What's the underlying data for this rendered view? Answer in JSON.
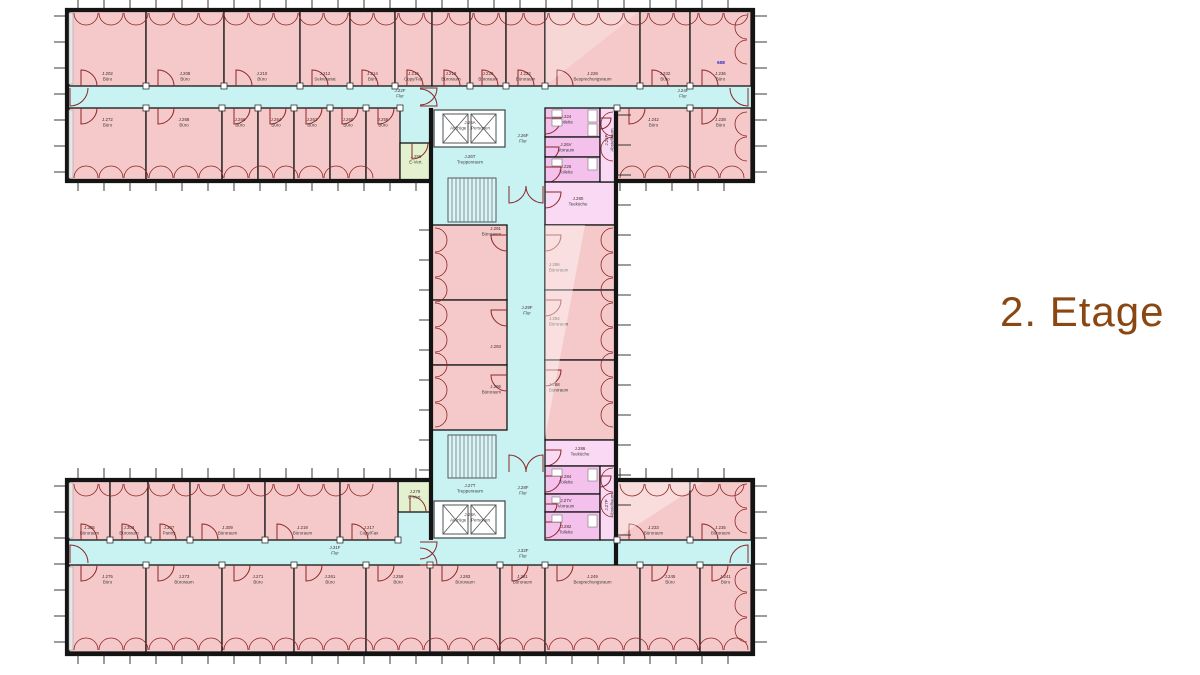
{
  "title": {
    "text": "2. Etage",
    "color": "#8a4711"
  },
  "colors": {
    "office": "#f5c9c9",
    "corridor": "#c9f3f3",
    "service": "#f4c0ec",
    "serviceLight": "#f9d9f4",
    "utility": "#e4f1cf",
    "wall": "#141414",
    "door": "#8d2525",
    "label": "#3c3c3c",
    "labelId": "#4a2b2b",
    "elevator": "#fbffff",
    "annotation": "#2323cc"
  },
  "floorplan": {
    "zones": [
      [
        69,
        86,
        682,
        22
      ],
      [
        69,
        540,
        682,
        25
      ],
      [
        507,
        108,
        38,
        457
      ],
      [
        398,
        108,
        34,
        36
      ],
      [
        398,
        512,
        34,
        28
      ],
      [
        432,
        108,
        75,
        117
      ],
      [
        432,
        430,
        75,
        110
      ]
    ],
    "rooms": [
      {
        "id": "J.202",
        "name": "Büro",
        "x": 69,
        "y": 11,
        "w": 77,
        "h": 75,
        "fill": "office",
        "door": "s"
      },
      {
        "id": "J.208",
        "name": "Büro",
        "x": 146,
        "y": 11,
        "w": 78,
        "h": 75,
        "fill": "office",
        "door": "s"
      },
      {
        "id": "J.210",
        "name": "Büro",
        "x": 224,
        "y": 11,
        "w": 76,
        "h": 75,
        "fill": "office",
        "door": "s"
      },
      {
        "id": "J.212",
        "name": "Sekretariat",
        "x": 300,
        "y": 11,
        "w": 50,
        "h": 75,
        "fill": "office",
        "door": "s"
      },
      {
        "id": "J.214",
        "name": "Büro",
        "x": 350,
        "y": 11,
        "w": 45,
        "h": 75,
        "fill": "office",
        "door": "s"
      },
      {
        "id": "J.216",
        "name": "Copy/Fax",
        "x": 395,
        "y": 11,
        "w": 37,
        "h": 75,
        "fill": "office",
        "door": "s"
      },
      {
        "id": "J.218",
        "name": "Büroraum",
        "x": 432,
        "y": 11,
        "w": 38,
        "h": 75,
        "fill": "office",
        "door": "s"
      },
      {
        "id": "J.220",
        "name": "Büroraum",
        "x": 470,
        "y": 11,
        "w": 36,
        "h": 75,
        "fill": "office",
        "door": "s"
      },
      {
        "id": "J.222",
        "name": "Büroraum",
        "x": 506,
        "y": 11,
        "w": 39,
        "h": 75,
        "fill": "office",
        "door": "s"
      },
      {
        "id": "J.228",
        "name": "Besprechungsraum",
        "x": 545,
        "y": 11,
        "w": 95,
        "h": 75,
        "fill": "office",
        "door": "s"
      },
      {
        "id": "J.232",
        "name": "Büro",
        "x": 640,
        "y": 11,
        "w": 50,
        "h": 75,
        "fill": "office",
        "door": "s"
      },
      {
        "id": "J.236",
        "name": "Büro",
        "x": 690,
        "y": 11,
        "w": 61,
        "h": 75,
        "fill": "office",
        "door": "s"
      },
      {
        "id": "J.272",
        "name": "Büro",
        "x": 69,
        "y": 108,
        "w": 77,
        "h": 72,
        "fill": "office",
        "door": "n"
      },
      {
        "id": "J.268",
        "name": "Büro",
        "x": 146,
        "y": 108,
        "w": 76,
        "h": 72,
        "fill": "office",
        "door": "n"
      },
      {
        "id": "J.266",
        "name": "Büro",
        "x": 222,
        "y": 108,
        "w": 36,
        "h": 72,
        "fill": "office",
        "door": "n"
      },
      {
        "id": "J.264",
        "name": "Büro",
        "x": 258,
        "y": 108,
        "w": 36,
        "h": 72,
        "fill": "office",
        "door": "n"
      },
      {
        "id": "J.262",
        "name": "Büro",
        "x": 294,
        "y": 108,
        "w": 36,
        "h": 72,
        "fill": "office",
        "door": "n"
      },
      {
        "id": "J.260",
        "name": "Büro",
        "x": 330,
        "y": 108,
        "w": 36,
        "h": 72,
        "fill": "office",
        "door": "n"
      },
      {
        "id": "J.258",
        "name": "Büro",
        "x": 366,
        "y": 108,
        "w": 34,
        "h": 72,
        "fill": "office",
        "door": "n"
      },
      {
        "id": "J.242",
        "name": "Büro",
        "x": 617,
        "y": 108,
        "w": 73,
        "h": 72,
        "fill": "office",
        "door": "n"
      },
      {
        "id": "J.238",
        "name": "Büro",
        "x": 690,
        "y": 108,
        "w": 61,
        "h": 72,
        "fill": "office",
        "door": "n"
      },
      {
        "id": "J.256",
        "name": "E-Vert.",
        "x": 400,
        "y": 143,
        "w": 32,
        "h": 37,
        "fill": "utility",
        "door": "n",
        "lx": 416,
        "ly": 158
      },
      {
        "id": "J.224",
        "name": "Toilette",
        "x": 545,
        "y": 108,
        "w": 55,
        "h": 29,
        "fill": "service",
        "door": "w",
        "lx": 566,
        "ly": 118
      },
      {
        "id": "J.26V",
        "name": "Vorraum",
        "x": 545,
        "y": 137,
        "w": 55,
        "h": 20,
        "fill": "service",
        "door": "w",
        "lx": 566,
        "ly": 146
      },
      {
        "id": "J.226",
        "name": "Toilette",
        "x": 545,
        "y": 157,
        "w": 55,
        "h": 25,
        "fill": "service",
        "door": "w",
        "lx": 566,
        "ly": 168
      },
      {
        "id": "J.280",
        "name": "Teeküche",
        "x": 545,
        "y": 182,
        "w": 72,
        "h": 43,
        "fill": "serviceLight",
        "door": "w",
        "lx": 578,
        "ly": 200
      },
      {
        "id": "J.26P",
        "name": "Abstellraum",
        "x": 600,
        "y": 108,
        "w": 17,
        "h": 74,
        "fill": "serviceLight",
        "door": "w",
        "lx": 608,
        "ly": 140,
        "rot": -90
      },
      {
        "id": "J.291",
        "name": "Büroraum",
        "x": 432,
        "y": 225,
        "w": 75,
        "h": 75,
        "fill": "office",
        "door": "e",
        "lx": 501,
        "ly": 230,
        "anchor": "end"
      },
      {
        "id": "J.293",
        "name": "",
        "x": 432,
        "y": 300,
        "w": 75,
        "h": 65,
        "fill": "office",
        "door": "e",
        "lx": 501,
        "ly": 348,
        "anchor": "end"
      },
      {
        "id": "J.295",
        "name": "Büroraum",
        "x": 432,
        "y": 365,
        "w": 75,
        "h": 65,
        "fill": "office",
        "door": "e",
        "lx": 501,
        "ly": 388,
        "anchor": "end"
      },
      {
        "id": "J.296",
        "name": "Büroraum",
        "x": 545,
        "y": 225,
        "w": 72,
        "h": 65,
        "fill": "office",
        "door": "w",
        "lx": 549,
        "ly": 266,
        "anchor": "start"
      },
      {
        "id": "J.294",
        "name": "Büroraum",
        "x": 545,
        "y": 290,
        "w": 72,
        "h": 70,
        "fill": "office",
        "door": "w",
        "lx": 549,
        "ly": 320,
        "anchor": "start"
      },
      {
        "id": "J.288",
        "name": "Büroraum",
        "x": 545,
        "y": 360,
        "w": 72,
        "h": 80,
        "fill": "office",
        "door": "w",
        "lx": 549,
        "ly": 386,
        "anchor": "start"
      },
      {
        "id": "J.286",
        "name": "Teeküche",
        "x": 545,
        "y": 440,
        "w": 72,
        "h": 26,
        "fill": "serviceLight",
        "door": "w",
        "lx": 580,
        "ly": 450
      },
      {
        "id": "J.284",
        "name": "Toilette",
        "x": 545,
        "y": 466,
        "w": 55,
        "h": 28,
        "fill": "service",
        "door": "w",
        "lx": 566,
        "ly": 478
      },
      {
        "id": "J.27V",
        "name": "Vorraum",
        "x": 545,
        "y": 494,
        "w": 55,
        "h": 18,
        "fill": "service",
        "door": "w",
        "lx": 566,
        "ly": 502
      },
      {
        "id": "J.282",
        "name": "Toilette",
        "x": 545,
        "y": 512,
        "w": 55,
        "h": 28,
        "fill": "service",
        "door": "w",
        "lx": 566,
        "ly": 528
      },
      {
        "id": "J.27P",
        "name": "Abstellraum",
        "x": 600,
        "y": 466,
        "w": 17,
        "h": 74,
        "fill": "serviceLight",
        "door": "w",
        "lx": 608,
        "ly": 505,
        "rot": -90
      },
      {
        "id": "J.279",
        "name": "E-Vert.",
        "x": 398,
        "y": 481,
        "w": 34,
        "h": 31,
        "fill": "utility",
        "door": "s",
        "lx": 415,
        "ly": 493
      },
      {
        "id": "J.305",
        "name": "Büroraum",
        "x": 69,
        "y": 481,
        "w": 41,
        "h": 59,
        "fill": "office",
        "door": "s"
      },
      {
        "id": "J.303",
        "name": "Büroraum",
        "x": 110,
        "y": 481,
        "w": 38,
        "h": 59,
        "fill": "office",
        "door": "s"
      },
      {
        "id": "J.307",
        "name": "Pantry",
        "x": 148,
        "y": 481,
        "w": 42,
        "h": 59,
        "fill": "office",
        "door": "s"
      },
      {
        "id": "J.309",
        "name": "Büroraum",
        "x": 190,
        "y": 481,
        "w": 75,
        "h": 59,
        "fill": "office",
        "door": "s"
      },
      {
        "id": "J.219",
        "name": "Büroraum",
        "x": 265,
        "y": 481,
        "w": 75,
        "h": 59,
        "fill": "office",
        "door": "s"
      },
      {
        "id": "J.217",
        "name": "Copy/Fax",
        "x": 340,
        "y": 481,
        "w": 58,
        "h": 59,
        "fill": "office",
        "door": "s"
      },
      {
        "id": "J.233",
        "name": "Büroraum",
        "x": 617,
        "y": 481,
        "w": 73,
        "h": 59,
        "fill": "office",
        "door": "s"
      },
      {
        "id": "J.235",
        "name": "Büroraum",
        "x": 690,
        "y": 481,
        "w": 61,
        "h": 59,
        "fill": "office",
        "door": "s"
      },
      {
        "id": "J.275",
        "name": "Büro",
        "x": 69,
        "y": 565,
        "w": 77,
        "h": 87,
        "fill": "office",
        "door": "n"
      },
      {
        "id": "J.273",
        "name": "Büroraum",
        "x": 146,
        "y": 565,
        "w": 76,
        "h": 87,
        "fill": "office",
        "door": "n"
      },
      {
        "id": "J.271",
        "name": "Büro",
        "x": 222,
        "y": 565,
        "w": 72,
        "h": 87,
        "fill": "office",
        "door": "n"
      },
      {
        "id": "J.261",
        "name": "Büro",
        "x": 294,
        "y": 565,
        "w": 72,
        "h": 87,
        "fill": "office",
        "door": "n"
      },
      {
        "id": "J.259",
        "name": "Büro",
        "x": 366,
        "y": 565,
        "w": 64,
        "h": 87,
        "fill": "office",
        "door": "n"
      },
      {
        "id": "J.283",
        "name": "Büroraum",
        "x": 430,
        "y": 565,
        "w": 70,
        "h": 87,
        "fill": "office",
        "door": "n"
      },
      {
        "id": "J.281",
        "name": "Büroraum",
        "x": 500,
        "y": 565,
        "w": 45,
        "h": 87,
        "fill": "office",
        "door": "n"
      },
      {
        "id": "J.249",
        "name": "Besprechungsraum",
        "x": 545,
        "y": 565,
        "w": 95,
        "h": 87,
        "fill": "office",
        "door": "n"
      },
      {
        "id": "J.245",
        "name": "Büro",
        "x": 640,
        "y": 565,
        "w": 60,
        "h": 87,
        "fill": "office",
        "door": "n"
      },
      {
        "id": "J.241",
        "name": "Büro",
        "x": 700,
        "y": 565,
        "w": 51,
        "h": 87,
        "fill": "office",
        "door": "n"
      }
    ],
    "area_labels": [
      {
        "id": "J.22F",
        "name": "Flur",
        "x": 400,
        "y": 92
      },
      {
        "id": "J.24F",
        "name": "Flur",
        "x": 683,
        "y": 92
      },
      {
        "id": "J.26F",
        "name": "Flur",
        "x": 523,
        "y": 137
      },
      {
        "id": "J.26A",
        "name": "Aufzüge f. Personen",
        "x": 470,
        "y": 124
      },
      {
        "id": "J.26T",
        "name": "Treppenraum",
        "x": 470,
        "y": 158
      },
      {
        "id": "J.29F",
        "name": "Flur",
        "x": 527,
        "y": 309
      },
      {
        "id": "J.28F",
        "name": "Flur",
        "x": 523,
        "y": 489
      },
      {
        "id": "J.27T",
        "name": "Treppenraum",
        "x": 470,
        "y": 487
      },
      {
        "id": "J.28A",
        "name": "Aufzüge f. Personen",
        "x": 470,
        "y": 516
      },
      {
        "id": "J.31F",
        "name": "Flur",
        "x": 335,
        "y": 549
      },
      {
        "id": "J.32F",
        "name": "Flur",
        "x": 523,
        "y": 552
      }
    ],
    "annotations": [
      {
        "text": "608",
        "x": 721,
        "y": 64
      }
    ]
  }
}
